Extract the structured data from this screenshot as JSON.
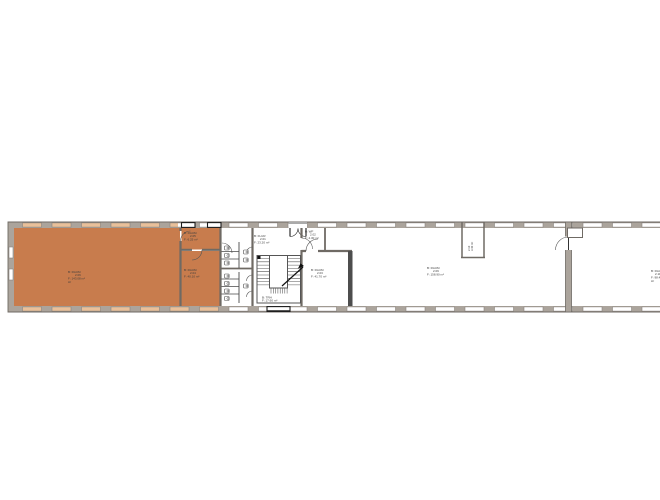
{
  "plan": {
    "colors": {
      "highlight": "#c87c4d",
      "highlight_window": "#e9c09a",
      "wall_band": "#aba49c",
      "wall_line": "#6f6a64",
      "dark": "#1c1c1c",
      "thick_wall": "#4d4d4d",
      "label": "#3d3d3d"
    },
    "labels": {
      "room_a": {
        "l1": "B: RAUM",
        "l2": "2.06",
        "l3": "F: 143.08 m²",
        "l4": "LF"
      },
      "room_b": {
        "l1": "B: RAUM",
        "l2": "2.05",
        "l3": "F: 6.25 m²"
      },
      "room_c": {
        "l1": "B: RAUM",
        "l2": "2.04",
        "l3": "F: 40.10 m²"
      },
      "corridor": {
        "l1": "B: FLUR",
        "l2": "2.01",
        "l3": "F: 23.20 m²"
      },
      "vestibule": {
        "l1": "B: WF",
        "l2": "2.02",
        "l3": "F: 4.30 m²"
      },
      "stairwell": {
        "l1": "B: TRH",
        "l2": "F: 17.60 m²"
      },
      "room_d": {
        "l1": "B: RAUM",
        "l2": "2.03",
        "l3": "F: 41.70 m²"
      },
      "room_e": {
        "l1": "B: RAUM",
        "l2": "2.09",
        "l3": "F: 158.90 m²"
      },
      "shaft": {
        "l1": "2.10",
        "l2": "3.40 m²"
      },
      "room_f": {
        "l1": "B: RAUM",
        "l2": "2.11",
        "l3": "F: 98.40",
        "l4": "LF"
      }
    }
  }
}
